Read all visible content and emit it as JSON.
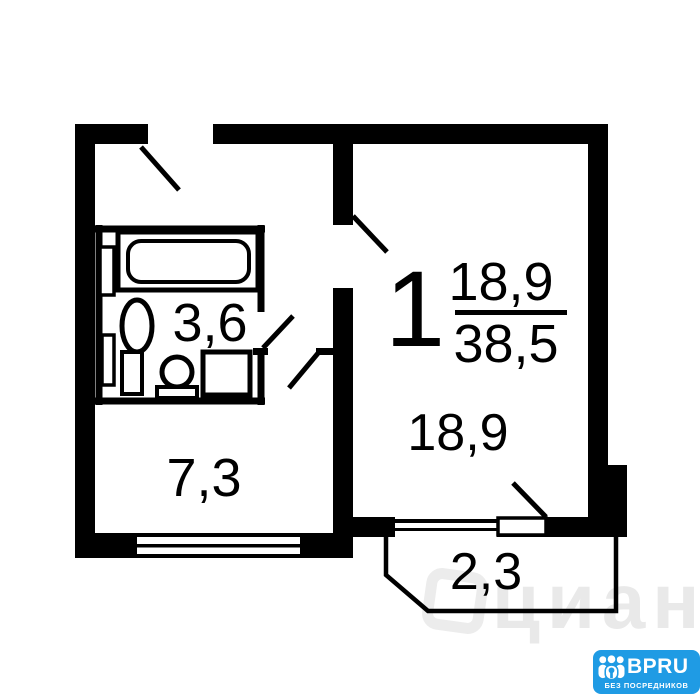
{
  "plan": {
    "room_count": "1",
    "living_area": "18,9",
    "total_area": "38,5",
    "bathroom_area": "3,6",
    "hallway_area": "7,3",
    "room_area": "18,9",
    "balcony_area": "2,3"
  },
  "watermark": {
    "text": "циан"
  },
  "logo": {
    "brand": "BPRU",
    "tagline": "БЕЗ ПОСРЕДНИКОВ",
    "background_color": "#1f9be4"
  },
  "colors": {
    "line": "#000000",
    "background": "#ffffff",
    "watermark": "#e9e9e9"
  }
}
